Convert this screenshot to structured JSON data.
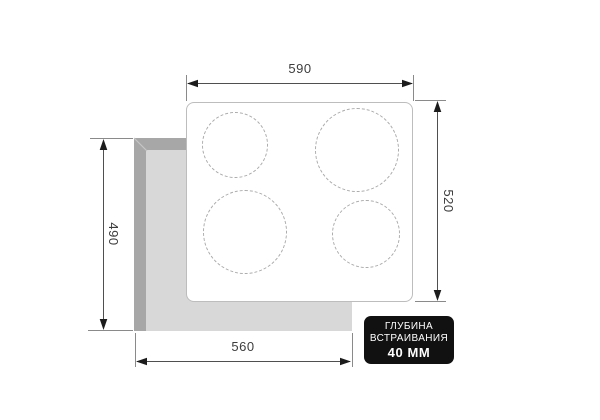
{
  "diagram": {
    "title": "built-in hob cutout dimensions drawing",
    "dims": {
      "top": "590",
      "right": "520",
      "left": "490",
      "bottom": "560"
    },
    "badge": {
      "line1": "ГЛУБИНА",
      "line2": "ВСТРАИВАНИЯ",
      "line3": "40 ММ"
    },
    "colors": {
      "cutout_wall": "#a7a7a7",
      "cutout_floor": "#d8d8d8",
      "panel_border": "#bdbdbd",
      "burner_outline": "#ababab",
      "dimension_line": "#4f4f4f",
      "label_text": "#3d3d3d",
      "badge_background": "#111111",
      "badge_text": "#ffffff"
    }
  }
}
